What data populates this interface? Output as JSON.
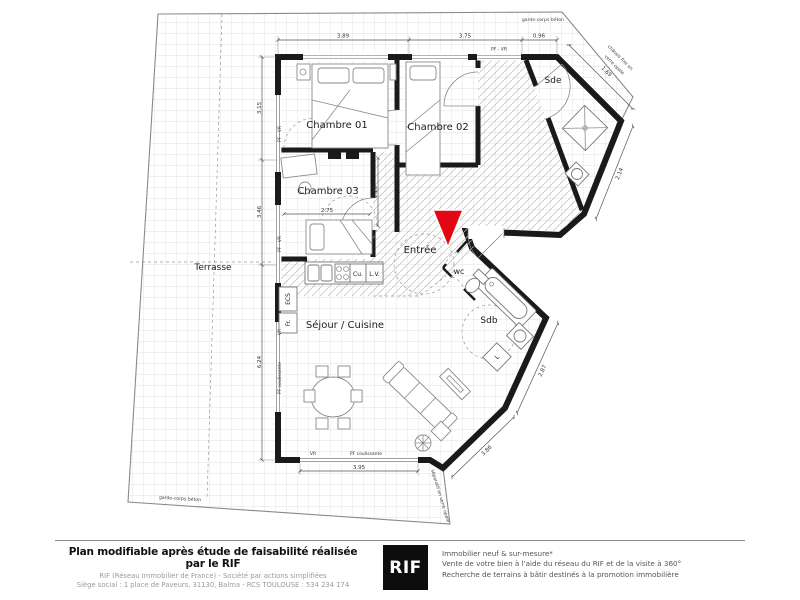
{
  "plan": {
    "rooms": {
      "terrasse": "Terrasse",
      "chambre01": "Chambre 01",
      "chambre02": "Chambre 02",
      "chambre03": "Chambre 03",
      "entree": "Entrée",
      "sejour_cuisine": "Séjour / Cuisine",
      "sde": "Sde",
      "wc": "wc",
      "sdb": "Sdb"
    },
    "equipment": {
      "cuisson": "Cu.",
      "lave_vaisselle": "L.V.",
      "ecs": "ECS",
      "frigo": "Fr.",
      "lave_linge": "L"
    },
    "openings": {
      "pf_vr": "PF - VR",
      "vr": "VR",
      "pf_coulissante": "PF coulissante"
    },
    "annotations": {
      "garde_corps_top": "garde-corps béton",
      "garde_corps_bottom": "garde-corps béton",
      "chassis_line1": "châssis fixe en",
      "chassis_line2": "verre opale",
      "separatif": "séparatif en verre opale"
    },
    "dimensions": {
      "top_left": "3.89",
      "top_mid": "3.75",
      "top_right": "0.96",
      "diag_sde_top": "1.69",
      "diag_sde_side": "2.14",
      "diag_sdb": "2.87",
      "diag_sejour": "3.86",
      "left_upper": "3.15",
      "left_mid": "3.46",
      "left_lower": "6.24",
      "bottom": "3.95",
      "chambre03_width": "2.75",
      "hall_width": "1.20"
    }
  },
  "colors": {
    "wall": "#1a1a1a",
    "entrance_arrow": "#e30613",
    "terrace_grid": "#d9d9d9",
    "dim": "#555555"
  },
  "footer": {
    "disclaimer_bold": "Plan modifiable après étude de faisabilité réalisée par le RIF",
    "company_line1": "RIF (Réseau Immobilier de France) - Société par actions simplifiées",
    "company_line2": "Siège social : 1 place de Paveurs, 31130, Balma - RCS TOULOUSE : 534 234 174",
    "logo_text": "RIF",
    "services": [
      "Immobilier neuf & sur-mesure*",
      "Vente de votre bien à l'aide du réseau du RIF et de la visite à 360°",
      "Recherche de terrains à bâtir destinés à la promotion immobilière"
    ]
  }
}
